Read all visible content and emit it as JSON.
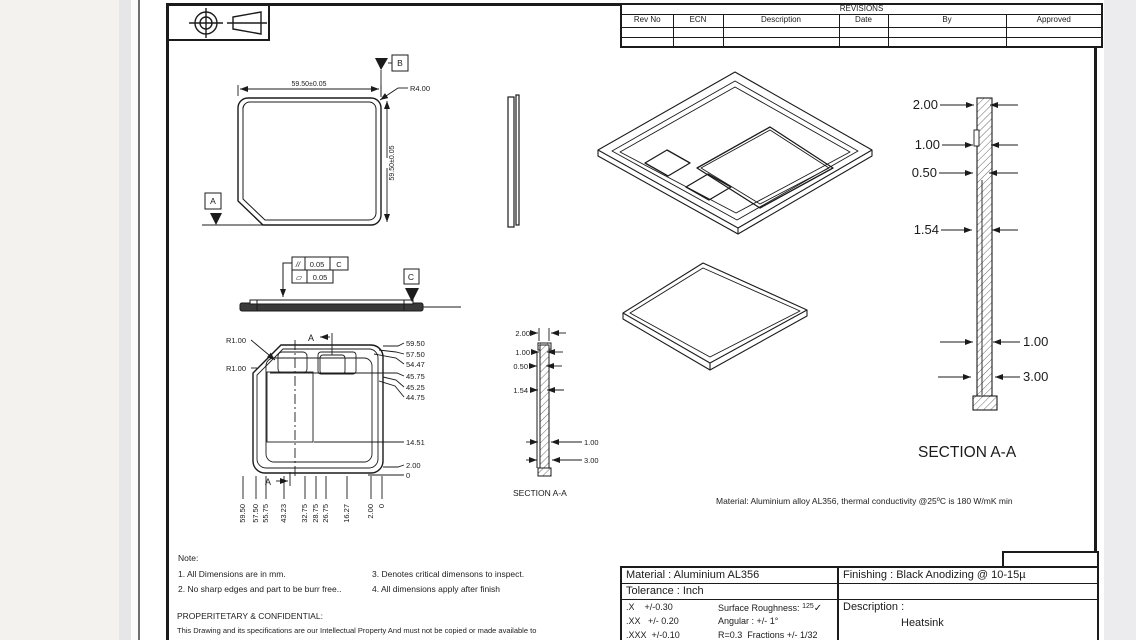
{
  "revisions": {
    "title": "REVISIONS",
    "columns": [
      "Rev No",
      "ECN",
      "Description",
      "Date",
      "By",
      "Approved"
    ]
  },
  "front_view": {
    "width_dim": "59.50±0.05",
    "height_dim": "59.50±0.05",
    "radius": "R4.00",
    "datum_a": "A",
    "datum_b": "B"
  },
  "side_view": {
    "parallelism_symbol": "//",
    "parallelism_value": "0.05",
    "parallelism_datum": "C",
    "flatness_symbol": "▱",
    "flatness_value": "0.05",
    "datum_c": "C"
  },
  "detail_view": {
    "r1": "R1.00",
    "r2": "R1.00",
    "section_a_top": "A",
    "section_a_bottom": "A",
    "right_dims": [
      "59.50",
      "57.50",
      "54.47",
      "45.75",
      "45.25",
      "44.75",
      "14.51",
      "2.00",
      "0"
    ],
    "bottom_dims": [
      "59.50",
      "57.50",
      "55.75",
      "43.23",
      "32.75",
      "28.75",
      "26.75",
      "16.27",
      "2.00",
      "0"
    ]
  },
  "section_small": {
    "d_top": "2.00",
    "d1": "1.00",
    "d2": "0.50",
    "d3": "1.54",
    "d_r1": "1.00",
    "d_r2": "3.00",
    "title": "SECTION A-A"
  },
  "section_large": {
    "d_top": "2.00",
    "d1": "1.00",
    "d2": "0.50",
    "d3": "1.54",
    "d_r1": "1.00",
    "d_r2": "3.00",
    "title": "SECTION A-A"
  },
  "material_note": "Material: Aluminium alloy AL356, thermal conductivity @25ºC is 180 W/mK min",
  "notes": {
    "heading": "Note:",
    "n1": "1. All Dimensions are in mm.",
    "n2": "2. No sharp edges and part to be burr free..",
    "n3": "3. Denotes critical dimensons to inspect.",
    "n4": "4. All dimensions apply after finish",
    "prop_heading": "PROPERITETARY & CONFIDENTIAL:",
    "prop_text": "This Drawing and its specifications are our Intellectual Property And must not be copied or made available to"
  },
  "title_block": {
    "material": "Material : Aluminium AL356",
    "tolerance": "Tolerance : Inch",
    "tol_x": ".X    +/-0.30",
    "tol_xx": ".XX   +/- 0.20",
    "tol_xxx": ".XXX  +/-0.10",
    "surface_label": "Surface Roughness: ",
    "surface_num": "125",
    "surface_mark": "✓",
    "angular": "Angular : +/- 1°",
    "fractions": "R=0.3  Fractions +/- 1/32",
    "finishing": "Finishing : Black Anodizing @ 10-15µ",
    "part_no_label": "Part No  :",
    "part_no": "RFQ# 454",
    "description_label": "Description :",
    "description": "Heatsink"
  }
}
